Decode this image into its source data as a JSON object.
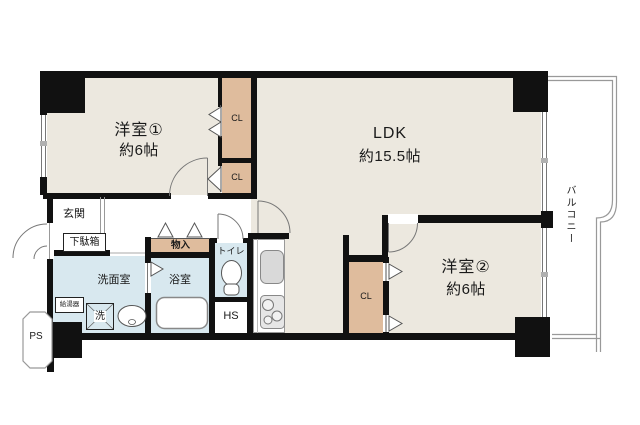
{
  "rooms": {
    "western1": {
      "name": "洋室①",
      "size": "約6帖"
    },
    "ldk": {
      "name": "LDK",
      "size": "約15.5帖"
    },
    "western2": {
      "name": "洋室②",
      "size": "約6帖"
    }
  },
  "labels": {
    "entrance": "玄関",
    "shoe_cabinet": "下駄箱",
    "storage": "物入",
    "toilet": "トイレ",
    "washroom": "洗面室",
    "bathroom": "浴室",
    "water_heater": "給湯器",
    "washing_machine": "洗",
    "hs": "HS",
    "ps": "PS",
    "balcony": "バルコニー",
    "cl": "CL"
  },
  "colors": {
    "wall": "#111111",
    "room_floor": "#ece8df",
    "closet": "#dfbc9d",
    "wet_area": "#d8e8ef",
    "railing": "#999999"
  }
}
